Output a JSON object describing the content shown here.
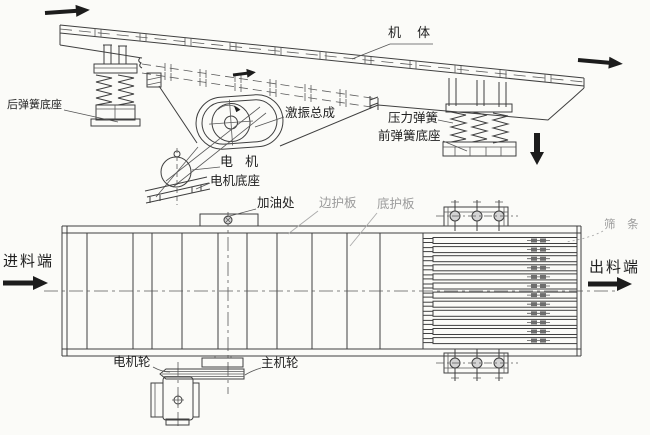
{
  "diagram": {
    "type": "engineering-drawing",
    "subject": "vibrating feeder structure: side elevation (top) and plan view (bottom)",
    "colors": {
      "line": "#3f3f3f",
      "label": "#1f1f1f",
      "muted_label": "#9b9b9b",
      "arrow": "#1c1c1c",
      "background": "#fbfbf8"
    },
    "side_view": {
      "labels": {
        "machine_body": "机 体",
        "rear_spring_base": "后弹簧底座",
        "exciter_assembly": "激振总成",
        "motor": "电 机",
        "motor_base": "电机底座",
        "pressure_spring": "压力弹簧",
        "front_spring_base": "前弹簧底座"
      }
    },
    "plan_view": {
      "labels": {
        "oil_fill_point": "加油处",
        "side_guard_plate": "边护板",
        "bottom_guard_plate": "底护板",
        "screen_bars": "筛 条",
        "feed_end": "进料端",
        "discharge_end": "出料端",
        "motor_pulley": "电机轮",
        "main_pulley": "主机轮"
      }
    },
    "icons": {
      "flow_arrow_top_left": "→",
      "flow_arrow_top_right": "→",
      "vibration_arrow_small": "→",
      "down_arrow": "↓",
      "feed_arrow": "→",
      "discharge_arrow": "→",
      "rotation_arc": "↻"
    }
  }
}
